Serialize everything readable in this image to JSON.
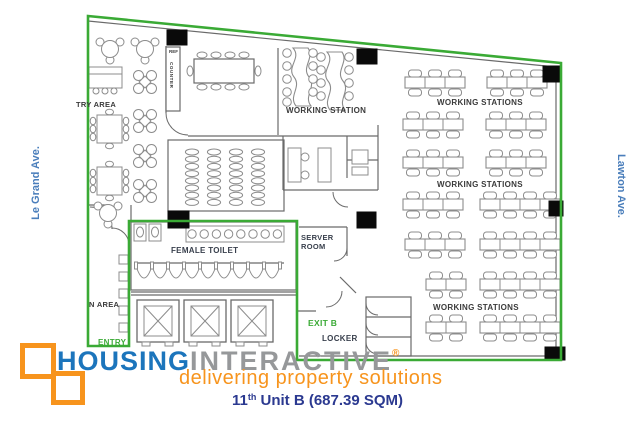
{
  "colors": {
    "boundary_green": "#3aaa35",
    "street_blue": "#4a7ebb",
    "logo_blue": "#1c75bc",
    "logo_gray": "#96989a",
    "brand_orange": "#f7941d",
    "title_navy": "#2b3990",
    "wall_gray": "#6a6a6a",
    "furniture_gray": "#8c8c8c",
    "column_black": "#0a0a0a"
  },
  "streets": {
    "left": "Le Grand Ave.",
    "right": "Lawton Ave."
  },
  "plan": {
    "pantry_area": "TRY AREA",
    "ref": "REF",
    "counter": "COUNTER",
    "working_station": "WORKING STATION",
    "working_stations_top": "WORKING STATIONS",
    "working_stations_mid": "WORKING STATIONS",
    "working_stations_bottom": "WORKING STATIONS",
    "server_room_line1": "SERVER",
    "server_room_line2": "ROOM",
    "female_toilet": "FEMALE TOILET",
    "n_area": "N AREA",
    "entry": "ENTRY",
    "exit_b": "EXIT B",
    "locker": "LOCKER"
  },
  "branding": {
    "logo_part1": "HOUSING",
    "logo_part2": "INTERACTIVE",
    "registered": "®",
    "tagline": "delivering property solutions"
  },
  "title": {
    "number": "11",
    "ordinal": "th",
    "rest": " Unit B (687.39 SQM)"
  }
}
